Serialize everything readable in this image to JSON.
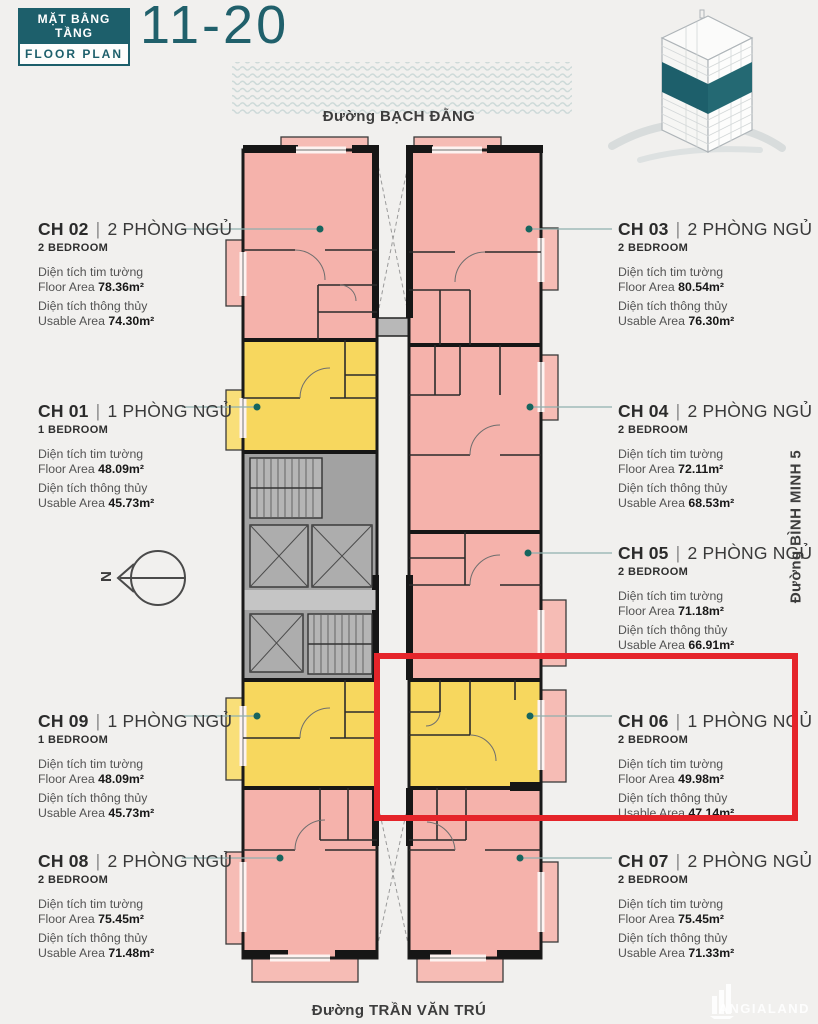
{
  "header": {
    "badge_top": "MẶT BẰNG TẦNG",
    "badge_bottom": "FLOOR PLAN",
    "floor_range": "11-20"
  },
  "streets": {
    "top": "Đường BẠCH ĐẰNG",
    "right": "Đường BÌNH MINH 5",
    "bottom": "Đường TRẦN VĂN TRÚ"
  },
  "compass": {
    "label": "N"
  },
  "separator": "|",
  "area_labels": {
    "floor_vi": "Diện tích tim tường",
    "floor_en": "Floor Area",
    "usable_vi": "Diện tích thông thủy",
    "usable_en": "Usable Area"
  },
  "units": [
    {
      "id": "CH 02",
      "type_vi": "2 PHÒNG NGỦ",
      "type_en": "2 BEDROOM",
      "floor_area": "78.36m²",
      "usable_area": "74.30m²"
    },
    {
      "id": "CH 01",
      "type_vi": "1 PHÒNG NGỦ",
      "type_en": "1 BEDROOM",
      "floor_area": "48.09m²",
      "usable_area": "45.73m²"
    },
    {
      "id": "CH 09",
      "type_vi": "1 PHÒNG NGỦ",
      "type_en": "1 BEDROOM",
      "floor_area": "48.09m²",
      "usable_area": "45.73m²"
    },
    {
      "id": "CH 08",
      "type_vi": "2 PHÒNG NGỦ",
      "type_en": "2 BEDROOM",
      "floor_area": "75.45m²",
      "usable_area": "71.48m²"
    },
    {
      "id": "CH 03",
      "type_vi": "2 PHÒNG NGỦ",
      "type_en": "2 BEDROOM",
      "floor_area": "80.54m²",
      "usable_area": "76.30m²"
    },
    {
      "id": "CH 04",
      "type_vi": "2 PHÒNG NGỦ",
      "type_en": "2 BEDROOM",
      "floor_area": "72.11m²",
      "usable_area": "68.53m²"
    },
    {
      "id": "CH 05",
      "type_vi": "2 PHÒNG NGỦ",
      "type_en": "2 BEDROOM",
      "floor_area": "71.18m²",
      "usable_area": "66.91m²"
    },
    {
      "id": "CH 06",
      "type_vi": "1 PHÒNG NGỦ",
      "type_en": "2 BEDROOM",
      "floor_area": "49.98m²",
      "usable_area": "47.14m²"
    },
    {
      "id": "CH 07",
      "type_vi": "2 PHÒNG NGỦ",
      "type_en": "2 BEDROOM",
      "floor_area": "75.45m²",
      "usable_area": "71.33m²"
    }
  ],
  "watermark": "ANGIALAND",
  "colors": {
    "brand_teal": "#1d5f6b",
    "unit_pink": "#f5b2ab",
    "unit_yellow": "#f7d75e",
    "core_gray": "#a2a2a2",
    "highlight_red": "#e5242a"
  }
}
